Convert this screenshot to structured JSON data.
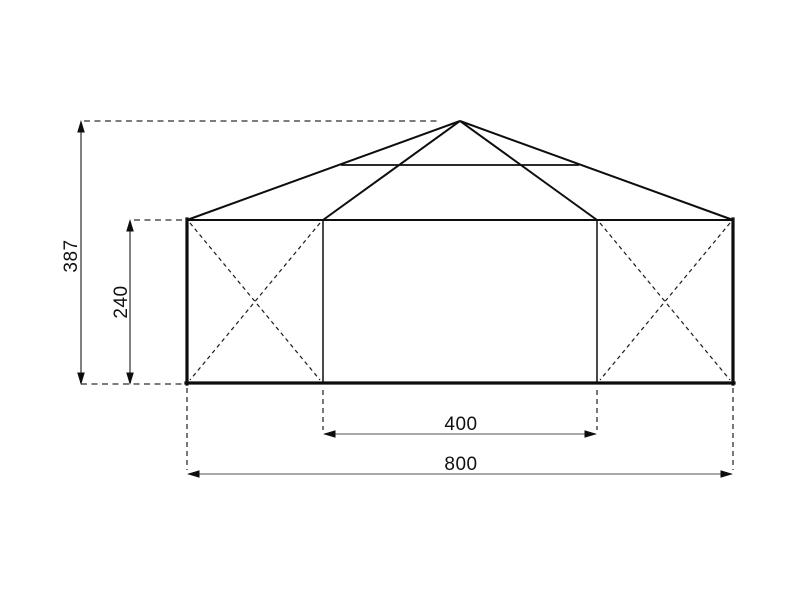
{
  "diagram": {
    "description": "Front elevation technical drawing of a hip-roof pavilion tent with three wall bays; the two outer bays carry dashed X cross-braces; linear dimensions annotate overall height, wall height, centre bay width and overall width",
    "dimensions": {
      "total_height": "387",
      "wall_height": "240",
      "center_width": "400",
      "total_width": "800"
    },
    "colors": {
      "background": "#ffffff",
      "outline": "#0d0d0d",
      "brace_line": "#1a1a1a",
      "dimension_line": "#737373",
      "extension_line": "#2e2e2e",
      "arrowhead": "#0d0d0d",
      "label_text": "#111111"
    }
  }
}
